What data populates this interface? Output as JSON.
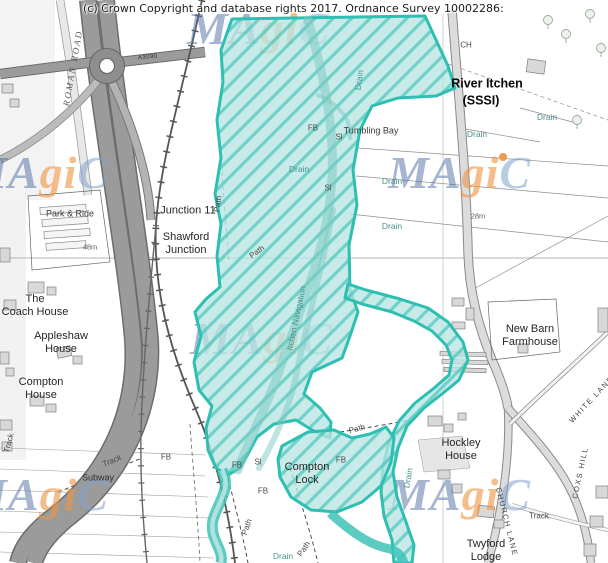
{
  "header": {
    "copyright": "(c) Crown Copyright and database rights 2017. Ordnance Survey 10002286:"
  },
  "watermark": {
    "part_blue": "MA",
    "part_orange": "gi",
    "part_light": "C",
    "color_blue": "#4d6ea2",
    "color_orange": "#ee9442",
    "color_light": "#82a2ce",
    "positions": [
      {
        "x": 187,
        "y": 2
      },
      {
        "x": -34,
        "y": 146
      },
      {
        "x": 388,
        "y": 146
      },
      {
        "x": 190,
        "y": 312
      },
      {
        "x": -34,
        "y": 468
      },
      {
        "x": 388,
        "y": 468
      }
    ]
  },
  "overlay": {
    "designation": "River Itchen (SSSI)",
    "fill": "#b9e4e1",
    "hatch": "#35c2b4",
    "border": "#2dbfb1"
  },
  "map_colors": {
    "motorway": "#9b9b9b",
    "road_fill": "#dcdcdc",
    "road_casing": "#8a8a8a",
    "railway": "#555555",
    "building": "#d8d8d8",
    "orange_marker": "#ef9a4f"
  },
  "labels": [
    {
      "text": "River Itchen",
      "x": 487,
      "y": 84,
      "rot": 0,
      "cls": "bold"
    },
    {
      "text": "(SSSI)",
      "x": 481,
      "y": 101,
      "rot": 0,
      "cls": "bold"
    },
    {
      "text": "Junction 11",
      "x": 188,
      "y": 211,
      "rot": 0,
      "cls": "place"
    },
    {
      "text": "Shawford\nJunction",
      "x": 186,
      "y": 244,
      "rot": 0,
      "cls": "place"
    },
    {
      "text": "Park & Ride",
      "x": 70,
      "y": 214,
      "rot": 0,
      "cls": "place-sm"
    },
    {
      "text": "The\nCoach House",
      "x": 35,
      "y": 306,
      "rot": 0,
      "cls": "place"
    },
    {
      "text": "Appleshaw\nHouse",
      "x": 61,
      "y": 343,
      "rot": 0,
      "cls": "place"
    },
    {
      "text": "Compton\nHouse",
      "x": 41,
      "y": 389,
      "rot": 0,
      "cls": "place"
    },
    {
      "text": "New Barn\nFarmhouse",
      "x": 530,
      "y": 336,
      "rot": 0,
      "cls": "place"
    },
    {
      "text": "Hockley\nHouse",
      "x": 461,
      "y": 450,
      "rot": 0,
      "cls": "place"
    },
    {
      "text": "Twyford\nLodge",
      "x": 486,
      "y": 551,
      "rot": 0,
      "cls": "place"
    },
    {
      "text": "Compton\nLock",
      "x": 307,
      "y": 474,
      "rot": 0,
      "cls": "place"
    },
    {
      "text": "Tumbling Bay",
      "x": 371,
      "y": 131,
      "rot": 0,
      "cls": "place-sm"
    },
    {
      "text": "Subway",
      "x": 98,
      "y": 478,
      "rot": 0,
      "cls": "feat-dk"
    },
    {
      "text": "Track",
      "x": 112,
      "y": 461,
      "rot": -22,
      "cls": "feat"
    },
    {
      "text": "Track",
      "x": 9,
      "y": 443,
      "rot": -75,
      "cls": "feat"
    },
    {
      "text": "Track",
      "x": 539,
      "y": 516,
      "rot": 0,
      "cls": "feat"
    },
    {
      "text": "CH",
      "x": 466,
      "y": 45,
      "rot": 0,
      "cls": "feat"
    },
    {
      "text": "48m",
      "x": 90,
      "y": 248,
      "rot": 0,
      "cls": "height"
    },
    {
      "text": "28m",
      "x": 478,
      "y": 217,
      "rot": 0,
      "cls": "height"
    },
    {
      "text": "Drain",
      "x": 299,
      "y": 169,
      "rot": 0,
      "cls": "water"
    },
    {
      "text": "Drain",
      "x": 392,
      "y": 181,
      "rot": 0,
      "cls": "water"
    },
    {
      "text": "Drain",
      "x": 392,
      "y": 226,
      "rot": 0,
      "cls": "water"
    },
    {
      "text": "Drain",
      "x": 477,
      "y": 134,
      "rot": 0,
      "cls": "water"
    },
    {
      "text": "Drain",
      "x": 547,
      "y": 117,
      "rot": 0,
      "cls": "water"
    },
    {
      "text": "Drain",
      "x": 283,
      "y": 556,
      "rot": 0,
      "cls": "water"
    },
    {
      "text": "Drain",
      "x": 359,
      "y": 80,
      "rot": -82,
      "cls": "water"
    },
    {
      "text": "Drain",
      "x": 408,
      "y": 478,
      "rot": -80,
      "cls": "water"
    },
    {
      "text": "Itchen Navigation",
      "x": 296,
      "y": 318,
      "rot": -78,
      "cls": "water"
    },
    {
      "text": "FB",
      "x": 313,
      "y": 128,
      "rot": 0,
      "cls": "feat"
    },
    {
      "text": "FB",
      "x": 166,
      "y": 457,
      "rot": 0,
      "cls": "feat"
    },
    {
      "text": "FB",
      "x": 237,
      "y": 465,
      "rot": 0,
      "cls": "feat"
    },
    {
      "text": "FB",
      "x": 263,
      "y": 491,
      "rot": 0,
      "cls": "feat"
    },
    {
      "text": "FB",
      "x": 341,
      "y": 460,
      "rot": 0,
      "cls": "feat"
    },
    {
      "text": "Sl",
      "x": 339,
      "y": 137,
      "rot": 0,
      "cls": "feat"
    },
    {
      "text": "Sl",
      "x": 328,
      "y": 188,
      "rot": 0,
      "cls": "feat"
    },
    {
      "text": "Sl",
      "x": 258,
      "y": 462,
      "rot": 0,
      "cls": "feat"
    },
    {
      "text": "Path",
      "x": 218,
      "y": 204,
      "rot": -80,
      "cls": "feat"
    },
    {
      "text": "Path",
      "x": 257,
      "y": 252,
      "rot": -35,
      "cls": "feat"
    },
    {
      "text": "Path",
      "x": 247,
      "y": 527,
      "rot": -70,
      "cls": "feat"
    },
    {
      "text": "Path",
      "x": 304,
      "y": 549,
      "rot": -55,
      "cls": "feat"
    },
    {
      "text": "Path",
      "x": 357,
      "y": 429,
      "rot": -15,
      "cls": "feat"
    },
    {
      "text": "WHITE LANE",
      "x": 592,
      "y": 400,
      "rot": -47,
      "cls": "road"
    },
    {
      "text": "COXS HILL",
      "x": 581,
      "y": 473,
      "rot": -78,
      "cls": "road"
    },
    {
      "text": "CHURCH LANE",
      "x": 506,
      "y": 522,
      "rot": 76,
      "cls": "road"
    },
    {
      "text": "ROMAN ROAD",
      "x": 73,
      "y": 68,
      "rot": -80,
      "cls": "roman"
    },
    {
      "text": "A3090",
      "x": 148,
      "y": 58,
      "rot": -6,
      "cls": "roadnum"
    }
  ]
}
